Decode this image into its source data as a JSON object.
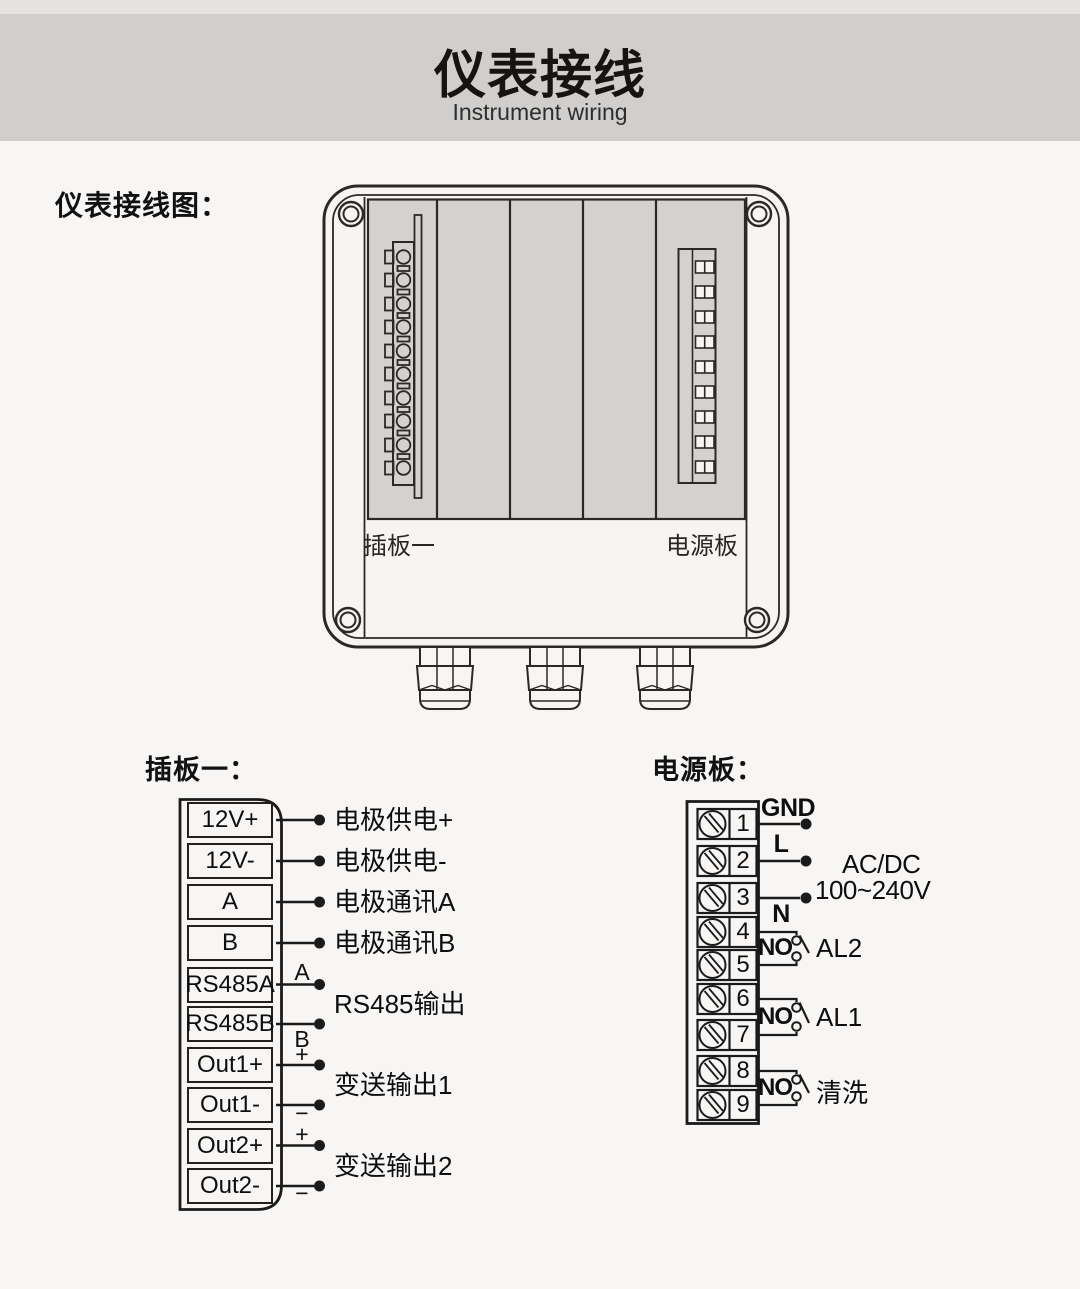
{
  "header": {
    "title": "仪表接线",
    "subtitle": "Instrument wiring"
  },
  "section_label": "仪表接线图：",
  "enclosure": {
    "board1_label": "插板一",
    "power_label": "电源板"
  },
  "board1": {
    "heading": "插板一：",
    "terminals": [
      "12V+",
      "12V-",
      "A",
      "B",
      "RS485A",
      "RS485B",
      "Out1+",
      "Out1-",
      "Out2+",
      "Out2-"
    ],
    "single_labels": [
      "电极供电+",
      "电极供电-",
      "电极通讯A",
      "电极通讯B"
    ],
    "wire_marks": {
      "rs485_a": "A",
      "rs485_b": "B",
      "out1_plus": "+",
      "out1_minus": "−",
      "out2_plus": "+",
      "out2_minus": "−"
    },
    "pair_labels": [
      "RS485输出",
      "变送输出1",
      "变送输出2"
    ]
  },
  "power_board": {
    "heading": "电源板：",
    "terminals": [
      "1",
      "2",
      "3",
      "4",
      "5",
      "6",
      "7",
      "8",
      "9"
    ],
    "wire_labels": [
      "GND",
      "L",
      "N"
    ],
    "supply_line1": "AC/DC",
    "supply_line2": "100~240V",
    "relays": [
      {
        "contact": "NO",
        "label": "AL2"
      },
      {
        "contact": "NO",
        "label": "AL1"
      },
      {
        "contact": "NO",
        "label": "清洗"
      }
    ]
  },
  "colors": {
    "background": "#f7f6f5",
    "header_band": "#d0cfce",
    "header_strip": "#e4e3e2",
    "panel_gray": "#d4d2d1",
    "line_dark": "#2e2824"
  }
}
